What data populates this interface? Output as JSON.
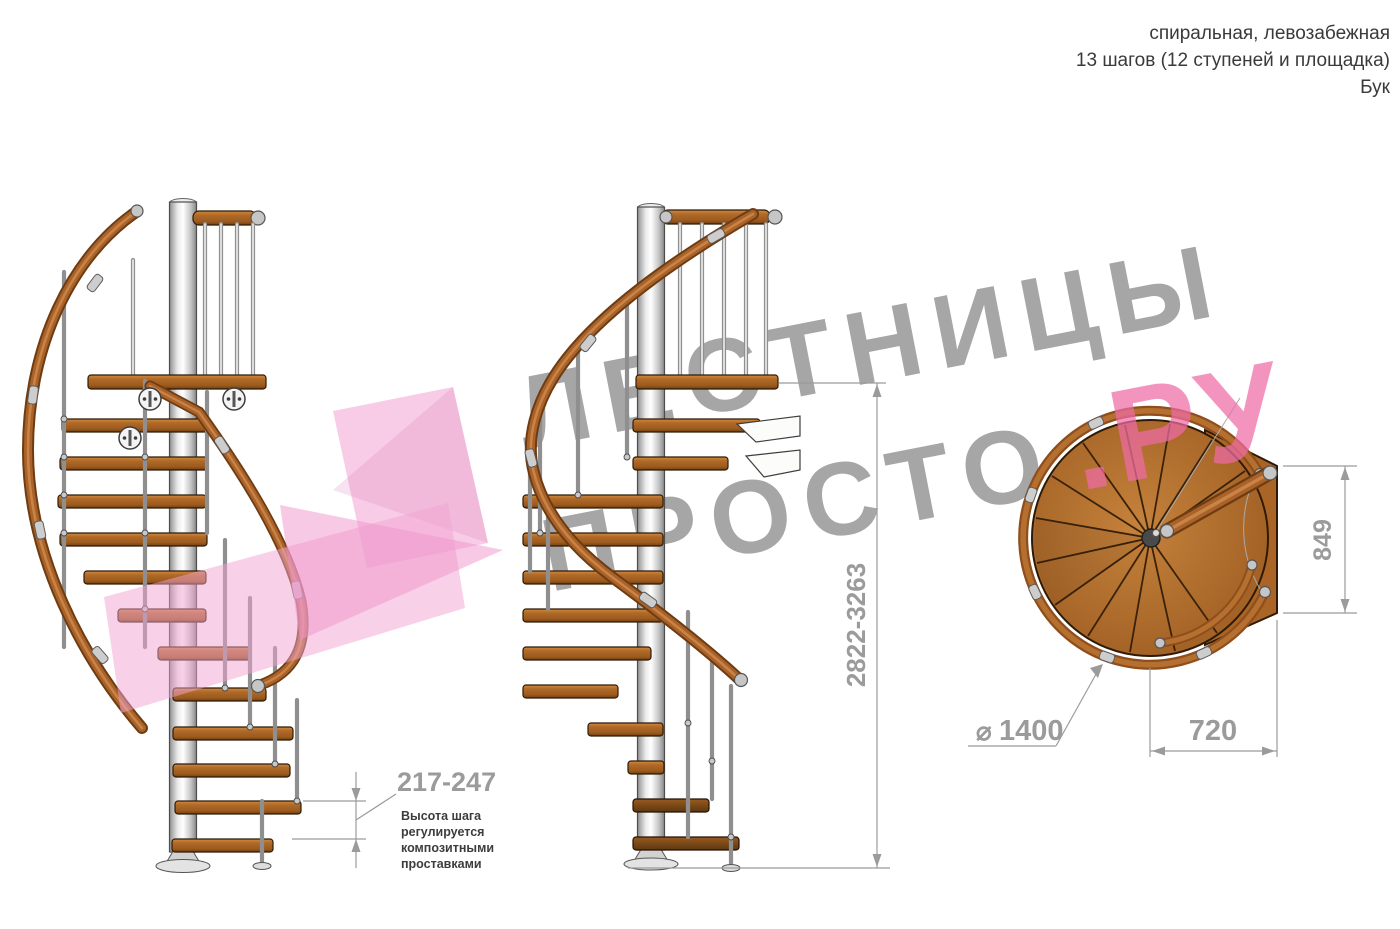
{
  "header": {
    "line1": "спиральная, левозабежная",
    "line2": "13 шагов (12 ступеней и площадка)",
    "line3": "Бук"
  },
  "watermark": {
    "line1": "ЛЕСТНИЦЫ",
    "line2_gray": "ПРОСТО",
    "line2_pink": ".РУ"
  },
  "dimensions": {
    "step_height": "217-247",
    "total_height": "2822-3263",
    "landing_depth": "849",
    "landing_width": "720",
    "diameter_symbol": "⌀",
    "diameter_value": "1400"
  },
  "note": {
    "line1": "Высота шага",
    "line2": "регулируется",
    "line3": "композитными",
    "line4": "проставками"
  },
  "colors": {
    "wood": "#a8622a",
    "wood_dark": "#6e3c10",
    "pole_metal": "#c9c9c9",
    "dimension_gray": "#9b9b9b",
    "watermark_gray": "#a6a6a6",
    "watermark_pink": "#ee6ba6",
    "note_text": "#3d3d3d"
  }
}
